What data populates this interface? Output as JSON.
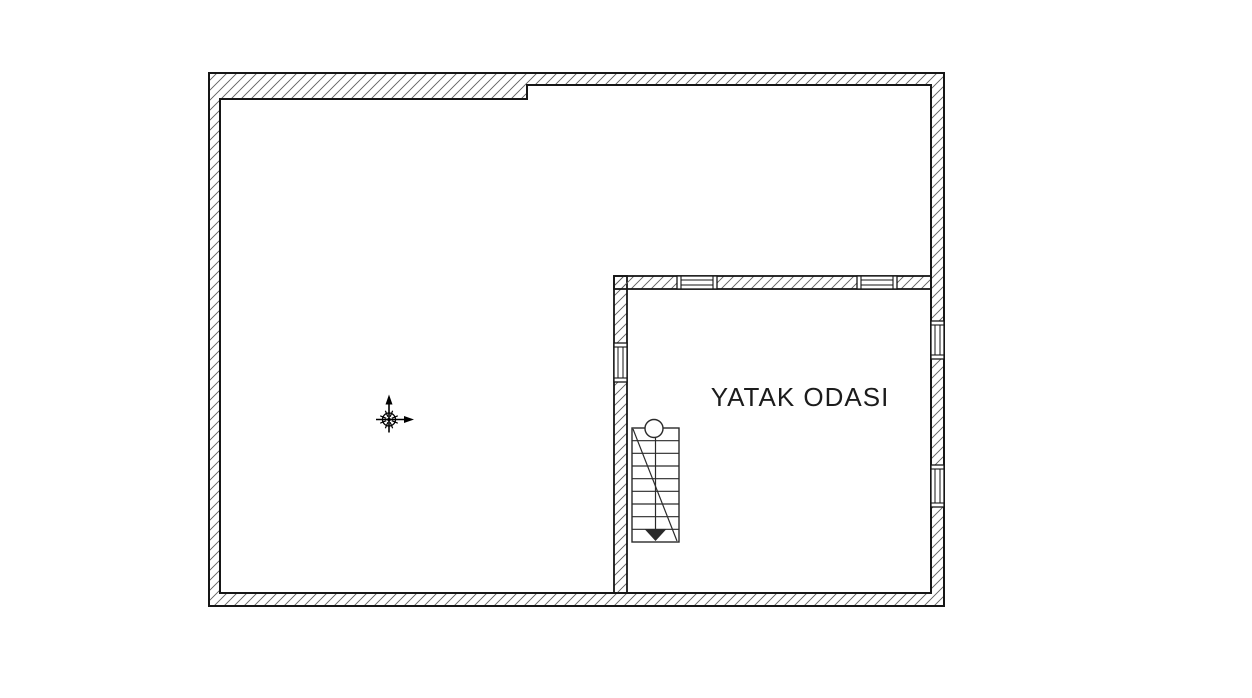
{
  "canvas": {
    "width": 1252,
    "height": 698,
    "background": "#ffffff"
  },
  "colors": {
    "wall_outline": "#161616",
    "hatch": "#5f5f5f",
    "window_line": "#161616",
    "stair_line": "#2a2a2a",
    "text": "#1c1c1c",
    "paper": "#ffffff"
  },
  "room": {
    "label": "YATAK ODASI",
    "font_size": 26,
    "letter_spacing": 1,
    "label_x": 800,
    "label_y": 406
  },
  "plan": {
    "outer_wall": {
      "x1": 209,
      "y1": 73,
      "x2": 944,
      "y2": 606
    },
    "inner_opening": [
      [
        220,
        99
      ],
      [
        527,
        99
      ],
      [
        527,
        85
      ],
      [
        931,
        85
      ],
      [
        931,
        593
      ],
      [
        220,
        593
      ]
    ],
    "interior_walls": [
      {
        "name": "bedroom-left-wall",
        "x": 614,
        "y": 276,
        "w": 13,
        "h": 317
      },
      {
        "name": "bedroom-top-wall",
        "x": 614,
        "y": 276,
        "w": 317,
        "h": 13
      }
    ],
    "windows": [
      {
        "name": "bedroom-top-window-1",
        "orientation": "h",
        "x": 677,
        "y": 276,
        "length": 40,
        "thickness": 13
      },
      {
        "name": "bedroom-top-window-2",
        "orientation": "h",
        "x": 857,
        "y": 276,
        "length": 40,
        "thickness": 13
      },
      {
        "name": "right-wall-window-upper",
        "orientation": "v",
        "x": 931,
        "y": 321,
        "length": 38,
        "thickness": 13
      },
      {
        "name": "right-wall-window-lower",
        "orientation": "v",
        "x": 931,
        "y": 465,
        "length": 42,
        "thickness": 13
      },
      {
        "name": "bedroom-left-window",
        "orientation": "v",
        "x": 614,
        "y": 343,
        "length": 39,
        "thickness": 13
      }
    ],
    "staircase": {
      "x": 632,
      "y": 428,
      "w": 47,
      "h": 114,
      "treads": 9,
      "circle_r": 9
    },
    "ucs_icon": {
      "x": 389,
      "y": 419.5,
      "arm": 16,
      "tail": 13,
      "arrow": 9,
      "circle_r": 6.5
    }
  }
}
